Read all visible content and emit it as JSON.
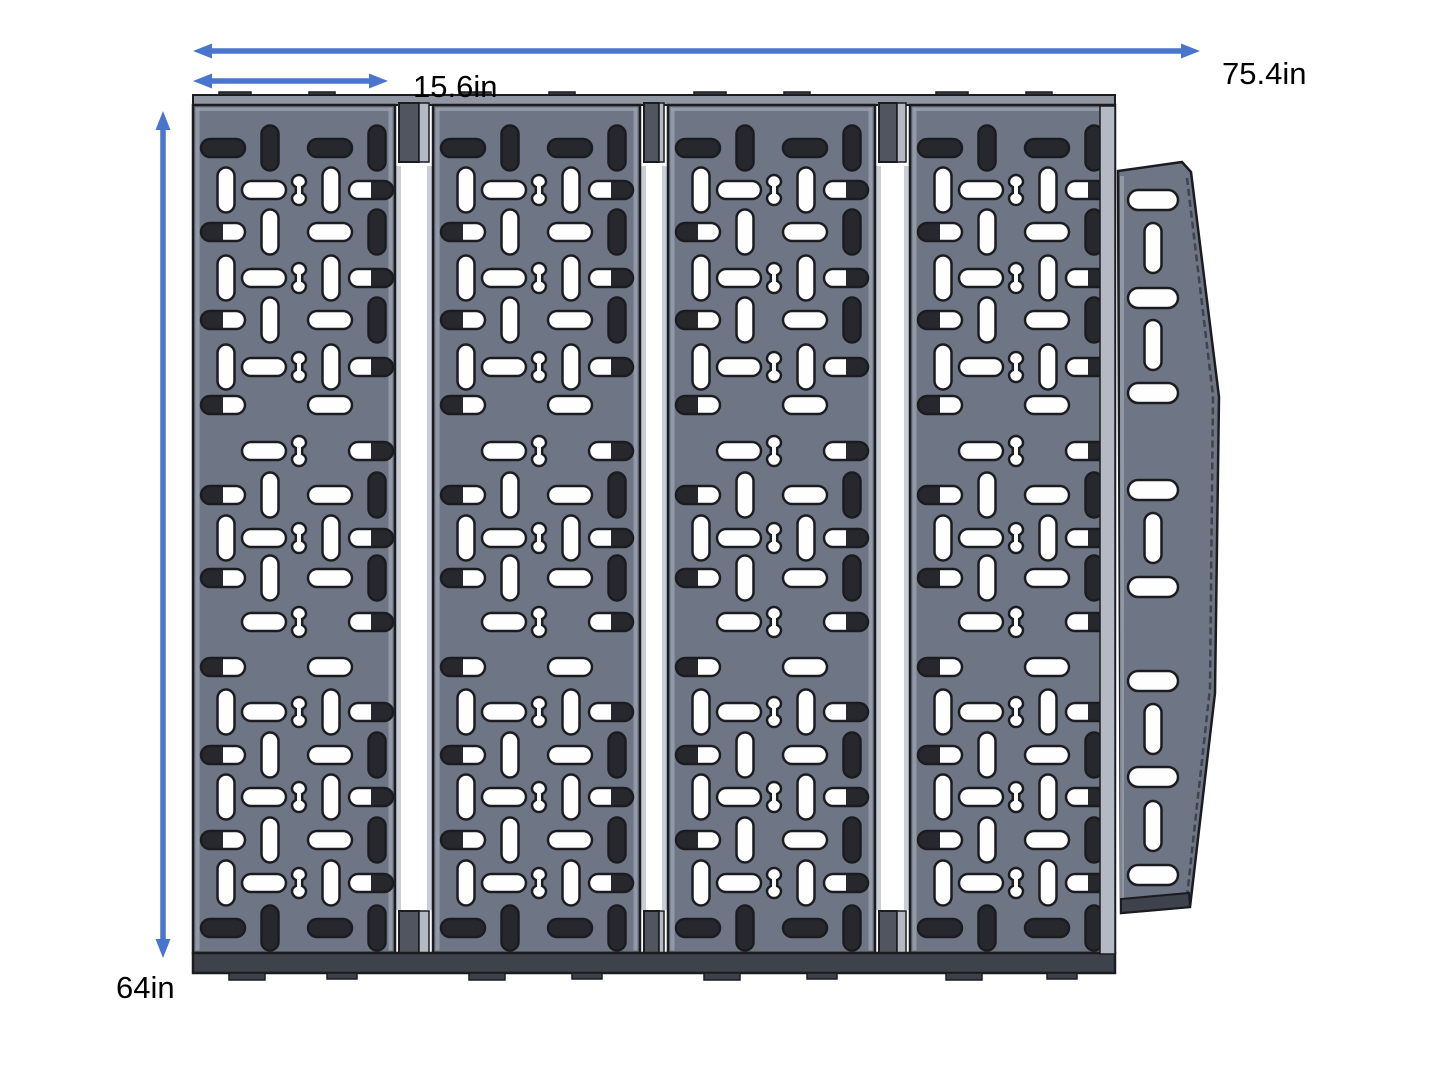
{
  "dimensions": {
    "total_width_label": "75.4in",
    "panel_width_label": "15.6in",
    "height_label": "64in"
  },
  "colors": {
    "arrow": "#4a75cc",
    "panel_face": "#6e7585",
    "outline": "#1b1c20",
    "slot_white": "#fefefe",
    "slot_dark": "#26282d",
    "edge_highlight": "#99a0ac",
    "flange_light": "#b4b9c3",
    "gap_strip": "#c9cdd5",
    "tab_dark": "#51555f",
    "top_strip": "#9096a2",
    "small_tab": "#3d4046",
    "bottom_band": "#3e424b",
    "bevel_line": "#3f434c",
    "label_color": "#000000"
  },
  "diagram": {
    "canvas": {
      "w": 1445,
      "h": 1084
    },
    "arrows": [
      {
        "type": "h",
        "x1": 193,
        "x2": 1200,
        "y": 51
      },
      {
        "type": "h",
        "x1": 193,
        "x2": 388,
        "y": 81
      },
      {
        "type": "v",
        "x": 163,
        "y1": 111,
        "y2": 958
      }
    ],
    "panels": [
      {
        "x": 193,
        "w": 202
      },
      {
        "x": 433,
        "w": 207
      },
      {
        "x": 668,
        "w": 207
      },
      {
        "x": 910,
        "w": 205
      }
    ],
    "panel_geom": {
      "top": 105,
      "bottom": 953
    },
    "gaps": [
      {
        "x": 395,
        "w": 38
      },
      {
        "x": 640,
        "w": 28
      },
      {
        "x": 875,
        "w": 35
      }
    ],
    "gap_geom": {
      "tab_top_y": 103,
      "tab_h": 59,
      "bot_tab_y": 911,
      "bot_tab_h": 44,
      "strip_y1": 166,
      "strip_y2": 910
    },
    "top_strip": {
      "x": 193,
      "y": 95,
      "w": 922,
      "h": 10
    },
    "bottom_band": {
      "x": 193,
      "y": 953,
      "w": 922,
      "h": 20
    },
    "slot_shapes": {
      "h": {
        "w": 44,
        "h": 18
      },
      "v": {
        "w": 17,
        "h": 45
      },
      "b": {
        "w": 16,
        "h": 30
      }
    },
    "rows": [
      {
        "y": 43,
        "slots": [
          {
            "t": "h",
            "x": 30,
            "f": "d"
          },
          {
            "t": "v",
            "x": 77,
            "f": "d"
          },
          {
            "t": "h",
            "x": 137,
            "f": "d"
          },
          {
            "t": "v",
            "x": 184,
            "f": "d"
          }
        ]
      },
      {
        "y": 85,
        "slots": [
          {
            "t": "v",
            "x": 33,
            "f": "w"
          },
          {
            "t": "h",
            "x": 71,
            "f": "w"
          },
          {
            "t": "b",
            "x": 106,
            "f": "w"
          },
          {
            "t": "v",
            "x": 138,
            "f": "w"
          },
          {
            "t": "h",
            "x": 178,
            "f": "dr"
          }
        ]
      },
      {
        "y": 127,
        "slots": [
          {
            "t": "h",
            "x": 30,
            "f": "dl"
          },
          {
            "t": "v",
            "x": 77,
            "f": "w"
          },
          {
            "t": "h",
            "x": 137,
            "f": "w"
          },
          {
            "t": "v",
            "x": 184,
            "f": "d"
          }
        ]
      },
      {
        "y": 173,
        "slots": [
          {
            "t": "v",
            "x": 33,
            "f": "w"
          },
          {
            "t": "h",
            "x": 71,
            "f": "w"
          },
          {
            "t": "b",
            "x": 106,
            "f": "w"
          },
          {
            "t": "v",
            "x": 138,
            "f": "w"
          },
          {
            "t": "h",
            "x": 178,
            "f": "dr"
          }
        ]
      },
      {
        "y": 215,
        "slots": [
          {
            "t": "h",
            "x": 30,
            "f": "dl"
          },
          {
            "t": "v",
            "x": 77,
            "f": "w"
          },
          {
            "t": "h",
            "x": 137,
            "f": "w"
          },
          {
            "t": "v",
            "x": 184,
            "f": "d"
          }
        ]
      },
      {
        "y": 262,
        "slots": [
          {
            "t": "v",
            "x": 33,
            "f": "w"
          },
          {
            "t": "h",
            "x": 71,
            "f": "w"
          },
          {
            "t": "b",
            "x": 106,
            "f": "w"
          },
          {
            "t": "v",
            "x": 138,
            "f": "w"
          },
          {
            "t": "h",
            "x": 178,
            "f": "dr"
          }
        ]
      },
      {
        "y": 300,
        "slots": [
          {
            "t": "h",
            "x": 30,
            "f": "dl"
          },
          {
            "t": "h",
            "x": 137,
            "f": "w"
          }
        ]
      },
      {
        "y": 346,
        "slots": [
          {
            "t": "h",
            "x": 71,
            "f": "w"
          },
          {
            "t": "b",
            "x": 106,
            "f": "w"
          },
          {
            "t": "h",
            "x": 178,
            "f": "dr"
          }
        ]
      },
      {
        "y": 390,
        "slots": [
          {
            "t": "h",
            "x": 30,
            "f": "dl"
          },
          {
            "t": "v",
            "x": 77,
            "f": "w"
          },
          {
            "t": "h",
            "x": 137,
            "f": "w"
          },
          {
            "t": "v",
            "x": 184,
            "f": "d"
          }
        ]
      },
      {
        "y": 433,
        "slots": [
          {
            "t": "v",
            "x": 33,
            "f": "w"
          },
          {
            "t": "h",
            "x": 71,
            "f": "w"
          },
          {
            "t": "b",
            "x": 106,
            "f": "w"
          },
          {
            "t": "v",
            "x": 138,
            "f": "w"
          },
          {
            "t": "h",
            "x": 178,
            "f": "dr"
          }
        ]
      },
      {
        "y": 473,
        "slots": [
          {
            "t": "h",
            "x": 30,
            "f": "dl"
          },
          {
            "t": "v",
            "x": 77,
            "f": "w"
          },
          {
            "t": "h",
            "x": 137,
            "f": "w"
          },
          {
            "t": "v",
            "x": 184,
            "f": "d"
          }
        ]
      },
      {
        "y": 517,
        "slots": [
          {
            "t": "h",
            "x": 71,
            "f": "w"
          },
          {
            "t": "b",
            "x": 106,
            "f": "w"
          },
          {
            "t": "h",
            "x": 178,
            "f": "dr"
          }
        ]
      },
      {
        "y": 562,
        "slots": [
          {
            "t": "h",
            "x": 30,
            "f": "dl"
          },
          {
            "t": "h",
            "x": 137,
            "f": "w"
          }
        ]
      },
      {
        "y": 607,
        "slots": [
          {
            "t": "v",
            "x": 33,
            "f": "w"
          },
          {
            "t": "h",
            "x": 71,
            "f": "w"
          },
          {
            "t": "b",
            "x": 106,
            "f": "w"
          },
          {
            "t": "v",
            "x": 138,
            "f": "w"
          },
          {
            "t": "h",
            "x": 178,
            "f": "dr"
          }
        ]
      },
      {
        "y": 650,
        "slots": [
          {
            "t": "h",
            "x": 30,
            "f": "dl"
          },
          {
            "t": "v",
            "x": 77,
            "f": "w"
          },
          {
            "t": "h",
            "x": 137,
            "f": "w"
          },
          {
            "t": "v",
            "x": 184,
            "f": "d"
          }
        ]
      },
      {
        "y": 692,
        "slots": [
          {
            "t": "v",
            "x": 33,
            "f": "w"
          },
          {
            "t": "h",
            "x": 71,
            "f": "w"
          },
          {
            "t": "b",
            "x": 106,
            "f": "w"
          },
          {
            "t": "v",
            "x": 138,
            "f": "w"
          },
          {
            "t": "h",
            "x": 178,
            "f": "dr"
          }
        ]
      },
      {
        "y": 735,
        "slots": [
          {
            "t": "h",
            "x": 30,
            "f": "dl"
          },
          {
            "t": "v",
            "x": 77,
            "f": "w"
          },
          {
            "t": "h",
            "x": 137,
            "f": "w"
          },
          {
            "t": "v",
            "x": 184,
            "f": "d"
          }
        ]
      },
      {
        "y": 778,
        "slots": [
          {
            "t": "v",
            "x": 33,
            "f": "w"
          },
          {
            "t": "h",
            "x": 71,
            "f": "w"
          },
          {
            "t": "b",
            "x": 106,
            "f": "w"
          },
          {
            "t": "v",
            "x": 138,
            "f": "w"
          },
          {
            "t": "h",
            "x": 178,
            "f": "dr"
          }
        ]
      },
      {
        "y": 823,
        "slots": [
          {
            "t": "h",
            "x": 30,
            "f": "d"
          },
          {
            "t": "v",
            "x": 77,
            "f": "d"
          },
          {
            "t": "h",
            "x": 137,
            "f": "d"
          },
          {
            "t": "v",
            "x": 184,
            "f": "d"
          }
        ]
      }
    ],
    "wing": {
      "polygon": "1118,171 1182,162 1191,172 1219,397 1215,693 1190,907 1121,913",
      "bevel": "1187,178 1213,396 1210,688 1187,896",
      "bottom_band": "1121,899 1189,893 1190,907 1121,913",
      "flange": {
        "x": 1100,
        "y": 106,
        "w": 15,
        "h": 848
      },
      "slot_cx": 1153,
      "h_slot": {
        "w": 50,
        "h": 20
      },
      "v_slot": {
        "w": 17,
        "h": 50
      },
      "h_ys": [
        200,
        298,
        393,
        490,
        587,
        681,
        777,
        875
      ],
      "v_ys": [
        248,
        345,
        538,
        729,
        826
      ]
    }
  }
}
